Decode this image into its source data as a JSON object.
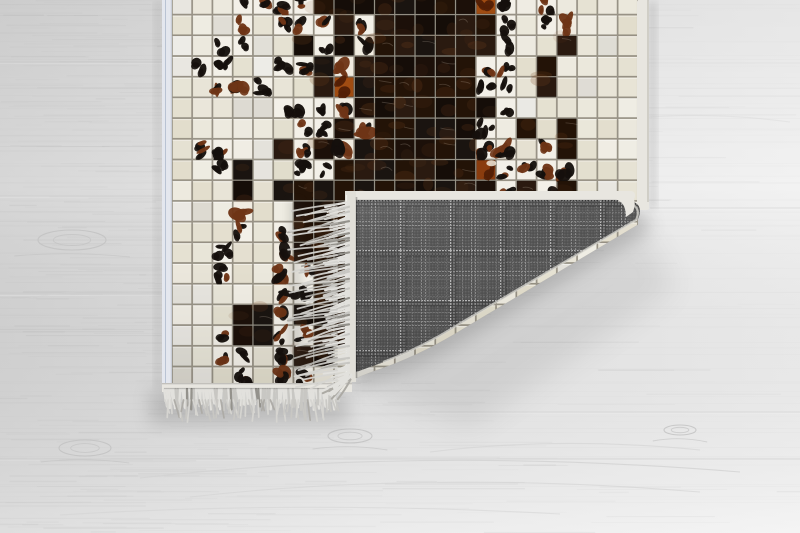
{
  "scene": {
    "type": "product-photo",
    "subject": "Patchwork cowhide rug with mosaic squares, corner folded over showing gray plaid woven backing and fringe, on light gray wood floor",
    "palette": {
      "floor_left": "#d7d7d7",
      "floor_mid": "#e7e7e7",
      "floor_right": "#f2f2f2",
      "floor_grain": "#9a9a9a",
      "floor_seam": "#c7c7c7",
      "floor_knot": "#c2c2c2",
      "grout": "#9b968a",
      "tile_cream_hue": 47,
      "tile_cream_sat": 27,
      "dark_variants": [
        "#150d08",
        "#1c1009",
        "#231307",
        "#2a1a10",
        "#1a1410"
      ],
      "white_base": "#f3f0e8",
      "brown_base": "#f1ece1",
      "spot_black": "#15100c",
      "spot_brown": "#6e3416",
      "orange_variants": [
        "#a04c12",
        "#8a3c0e"
      ],
      "orange_dark": "#531f06",
      "binding": "#e8e6e0",
      "binding_left": "#e4e7ee",
      "binding_blue_line": "#a8b4c8",
      "binding_edge": "#bdbab2",
      "fringe_colors": [
        "#e2e1dd",
        "#d6d5d1",
        "#c8c7c3",
        "#acaaa4",
        "#94928c"
      ],
      "plaid_base": "#575757",
      "plaid_dark": "#4a4a4a",
      "plaid_line_bright": "#b9b9b9",
      "plaid_line_mid": "#8f8f8f",
      "plaid_line_dim": "#757575",
      "crease_light": "#dbd9d3",
      "shadow": "#3c3c3c"
    },
    "rug": {
      "clip_path": "M160,0 L654,0 L654,208 Q652,214 644,221 L466,327 Q426,352 388,366 Q362,375 352,380 L352,394 L160,394 Z",
      "left_binding": {
        "x": 162,
        "y": 0,
        "w": 10,
        "h": 392
      },
      "right_binding": {
        "x": 637,
        "y": 0,
        "w": 12,
        "h": 210
      },
      "bottom_binding": {
        "x": 162,
        "y": 383,
        "w": 190,
        "h": 9
      },
      "mosaic": {
        "x": 172,
        "y": -6,
        "cols": 23,
        "rows": 19,
        "tile_w": 20.26,
        "tile_h": 20.7
      },
      "tile_legend": {
        "C": "cream",
        "K": "dark-cowhide",
        "W": "white-black-cowhide",
        "B": "brown-white-cowhide",
        "O": "rust-cowhide"
      },
      "tiles": [
        "CCCWWWWKKKKKKKKOWCWCCCC",
        "CCCWCWWWKWKKKKKKWCWBCCC",
        "CCWWCCKWKBKKKKKKWCCKCCC",
        "CWWCCWWKBKKKKKKWWCKCCCC",
        "CCBBWCCKOKKKKKKWWCKCCCC",
        "CCCCCWWWBKKKKKKKWCCCCCC",
        "CCCCCCWWKBKKKKKWCKCKCCC",
        "CWWCCKWKBKKKKKKWBCWKCCC",
        "CCWKCCWWKKKKKKKOWWWBCCC",
        "CCCKCKKKKKKKKKKKWKWKCCC",
        "CCCBCCKKKKKKKKKKCCCCCCC",
        "CCCWCWKKKKKKKKCCCCCCCCC",
        "CCWCCBKKKKKKKCCCCCCCCCC",
        "CCWCCBWKKKKKCCCCCCCCCCC",
        "CCCCCBWKKKKCCCCCCCCCCCC",
        "CCCKKWKKKKCCCCCCCCCCCCC",
        "CCWKKWWKKCCCCCCCCCCCCCC",
        "CCWWCWKKCCCCCCCCCCCCCCC",
        "CCCWCBWCCCCCCCCCCCCCCCC"
      ]
    },
    "fold": {
      "plaid_path": "M345,199 L622,199 Q646,201 638,219 L460,324 Q422,348 384,362 Q358,371 349,375 L345,374 Z",
      "crease_path": "M618,201 Q644,203 636,220 L459,324 Q421,348 383,362",
      "top_binding": {
        "x": 345,
        "y": 191,
        "w": 290,
        "h": 9
      },
      "left_binding": {
        "x": 345,
        "y": 191,
        "w": 11,
        "h": 191
      },
      "check_size": 25,
      "fringe": {
        "edge_x": 349,
        "y1": 202,
        "y2": 381,
        "max_len": 52
      }
    },
    "bottom_fringe": {
      "x1": 164,
      "x2": 336,
      "top": 389,
      "max_len": 30
    },
    "floor": {
      "seams": [
        {
          "y": 62,
          "x1": 0,
          "x2": 480,
          "op": 0.5
        },
        {
          "y": 196,
          "x1": 0,
          "x2": 165,
          "op": 0.4
        },
        {
          "y": 208,
          "x1": 650,
          "x2": 800,
          "op": 0.35
        },
        {
          "y": 294,
          "x1": 0,
          "x2": 480,
          "op": 0.55
        },
        {
          "y": 412,
          "x1": 430,
          "x2": 800,
          "op": 0.35
        },
        {
          "y": 459,
          "x1": 0,
          "x2": 800,
          "op": 0.45
        }
      ],
      "knots": [
        {
          "x": 72,
          "y": 240,
          "rx": 34,
          "ry": 10
        },
        {
          "x": 350,
          "y": 436,
          "rx": 22,
          "ry": 7
        },
        {
          "x": 680,
          "y": 430,
          "rx": 16,
          "ry": 5
        },
        {
          "x": 85,
          "y": 448,
          "rx": 26,
          "ry": 8
        }
      ],
      "grain_arcs": [
        {
          "d": "M140,478 Q420,446 740,472",
          "op": 0.8
        },
        {
          "d": "M190,497 Q430,470 700,492",
          "op": 0.6
        },
        {
          "d": "M60,515 Q300,500 560,514",
          "op": 0.5
        },
        {
          "d": "M430,452 Q560,436 700,450",
          "op": 0.6
        },
        {
          "d": "M20,300 Q90,284 170,296",
          "op": 0.5
        },
        {
          "d": "M620,120 Q700,110 790,122",
          "op": 0.3
        }
      ]
    }
  }
}
